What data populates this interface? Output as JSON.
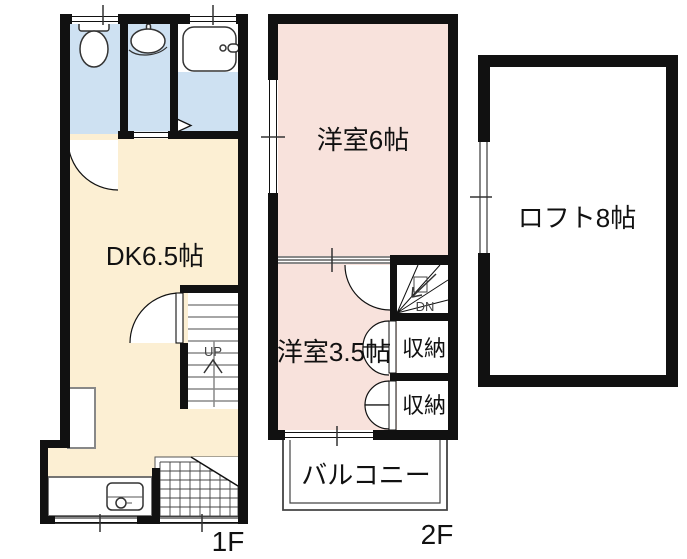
{
  "plan_1f": {
    "floor_label": "1F",
    "rooms": {
      "dk": "DK6.5帖"
    },
    "stairs_label": "UP"
  },
  "plan_2f": {
    "floor_label": "2F",
    "rooms": {
      "western6": "洋室6帖",
      "western35": "洋室3.5帖",
      "closet_upper": "収納",
      "closet_lower": "収納",
      "balcony": "バルコニー"
    },
    "stairs_label": "DN"
  },
  "plan_loft": {
    "rooms": {
      "loft": "ロフト8帖"
    }
  },
  "colors": {
    "wall": "#111111",
    "wet_area_fill": "#cee1f2",
    "dk_fill": "#fcefd3",
    "western_room_fill": "#f8e2dc",
    "bath_upper_fill": "#ffffff",
    "tread_gray": "#888888"
  },
  "icons": [
    "toilet-icon",
    "washbasin-icon",
    "bathtub-icon",
    "kitchen-sink-icon",
    "door-swing-arc",
    "window-marker",
    "stairs-up-arrow-icon",
    "stairs-down-arrow-icon",
    "entrance-tile-grid"
  ]
}
